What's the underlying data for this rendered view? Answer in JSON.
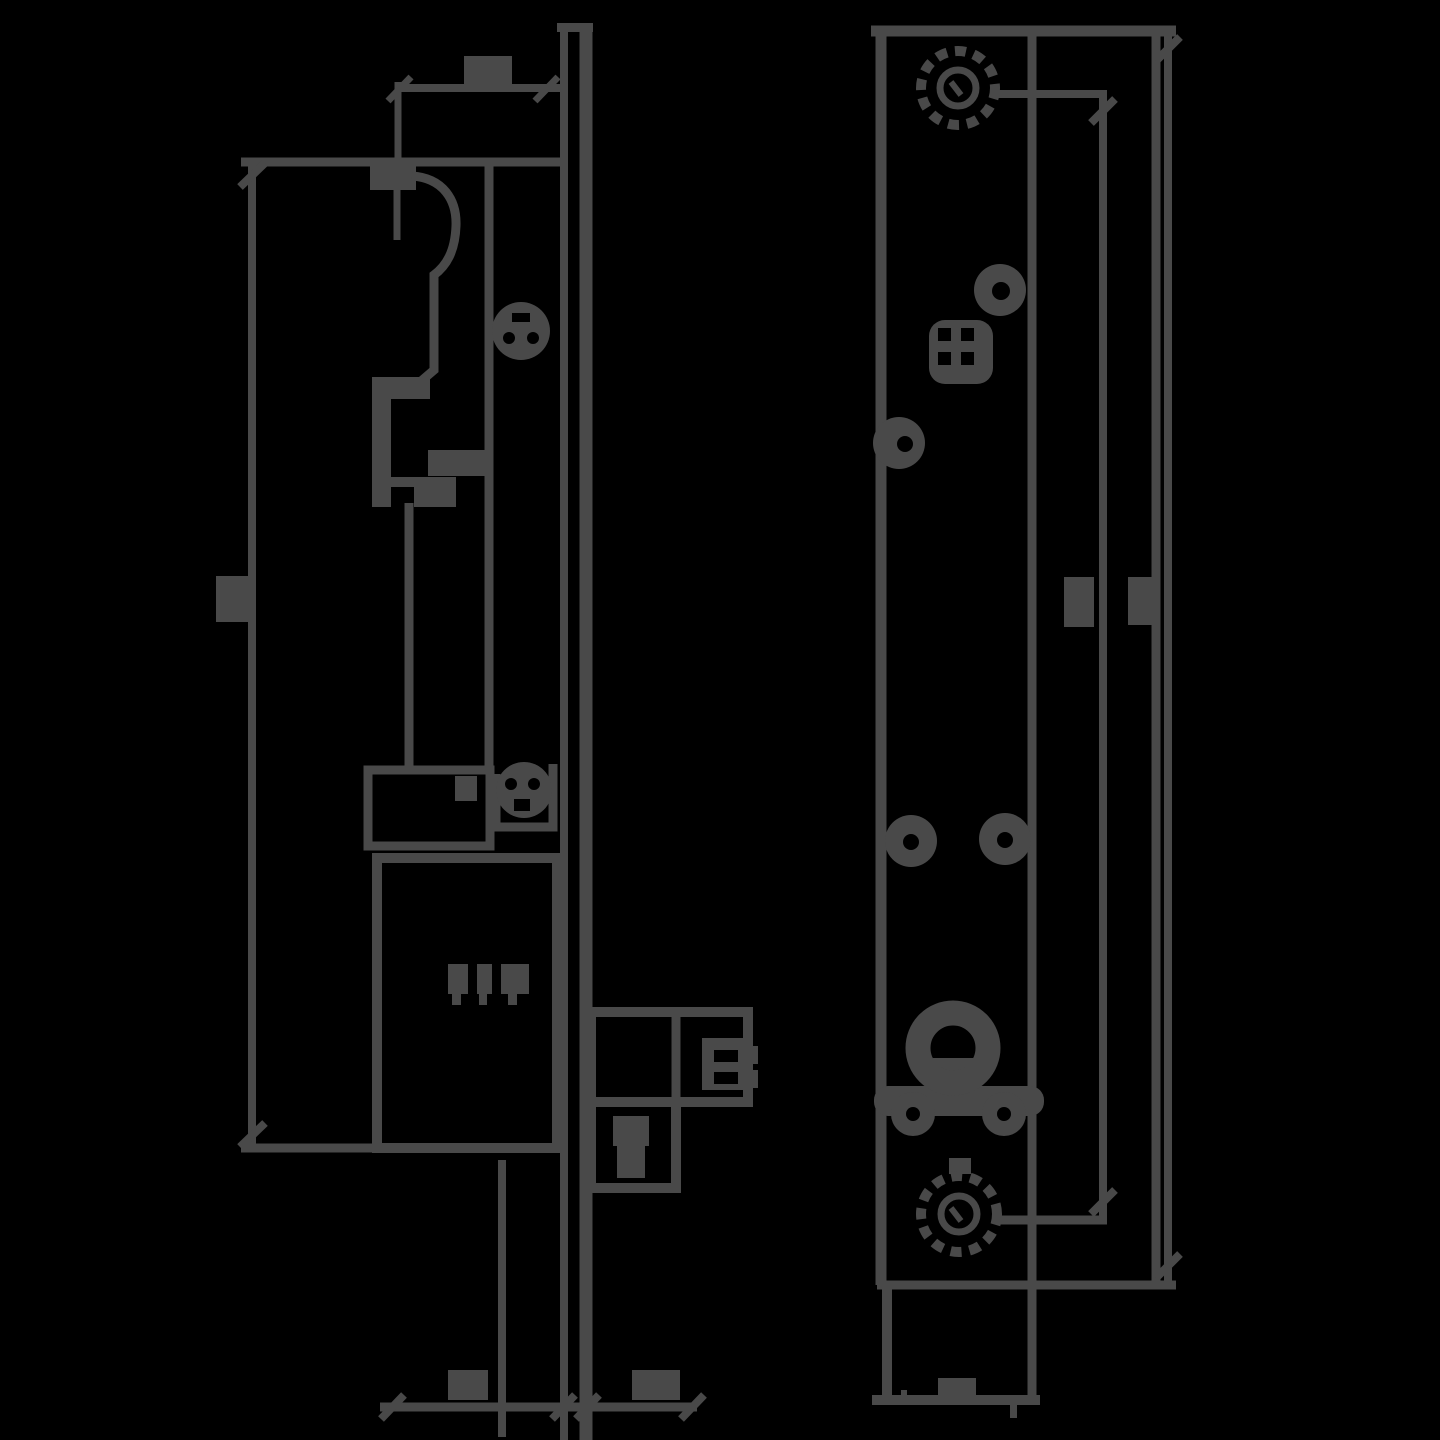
{
  "title": "",
  "diagram": {
    "type": "technical-drawing",
    "background_color": "#000000",
    "line_color": "#494949",
    "views": [
      {
        "id": "side-section-view",
        "label": "",
        "description": "left side profile of electric door strike: faceplate edge (double vertical line), latch cam arc, keeper bracket, solenoid body boxes, connector blocks"
      },
      {
        "id": "front-view",
        "label": "",
        "description": "right front view of faceplate: knurled screws top and bottom, round holes, four-hole adjustment pad, large cam hole cluster"
      }
    ],
    "dimension_labels": [
      {
        "id": "top-width-dim",
        "text": ""
      },
      {
        "id": "overall-height-dim-left",
        "text": ""
      },
      {
        "id": "bottom-width-left-dim",
        "text": ""
      },
      {
        "id": "bottom-width-right-dim",
        "text": ""
      },
      {
        "id": "screw-center-distance-dim",
        "text": ""
      },
      {
        "id": "faceplate-height-dim",
        "text": ""
      },
      {
        "id": "body-marking",
        "text": ""
      }
    ],
    "note": "all dimension text in the source bitmap is illegible pixel blobs; blobs reproduced as filled rectangles"
  }
}
